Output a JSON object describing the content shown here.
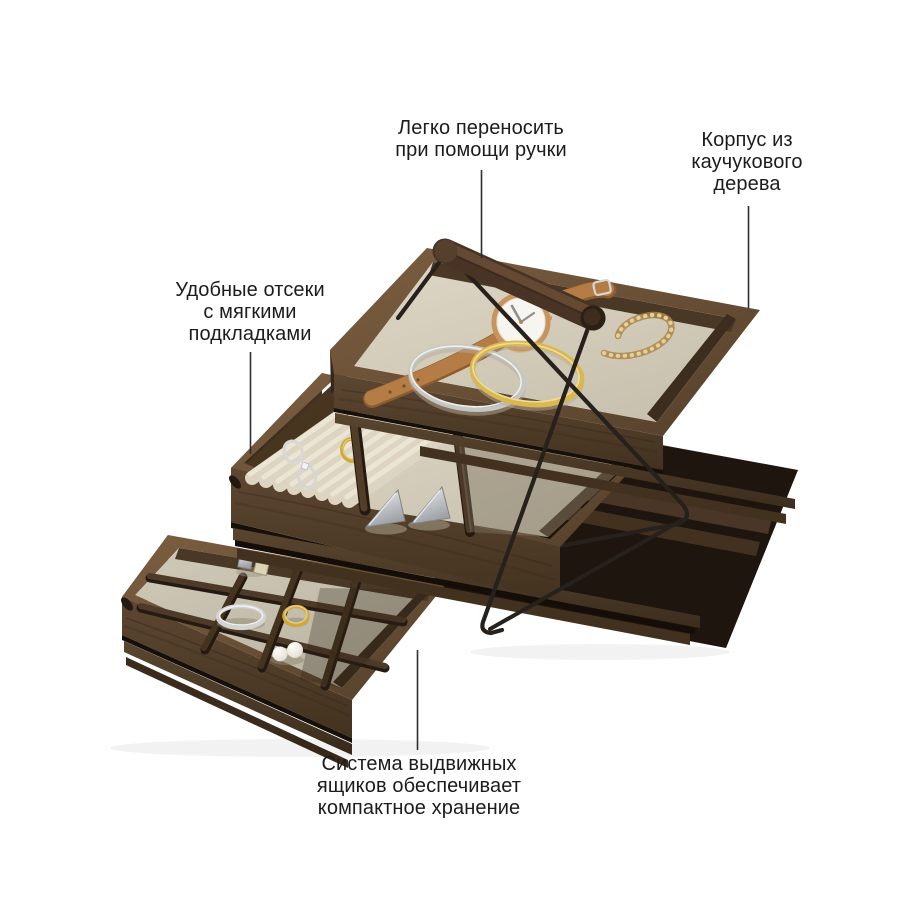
{
  "background": "#ffffff",
  "callouts": {
    "carry": {
      "lines": [
        "Легко переносить",
        "при помощи ручки"
      ]
    },
    "body": {
      "lines": [
        "Корпус из",
        "каучукового",
        "дерева"
      ]
    },
    "compartments": {
      "lines": [
        "Удобные отсеки",
        "с мягкими",
        "подкладками"
      ]
    },
    "drawers": {
      "lines": [
        "Система выдвижных",
        "ящиков обеспечивает",
        "компактное хранение"
      ]
    }
  },
  "palette": {
    "wood_dark": "#3a2b1e",
    "wood_mid": "#54402c",
    "wood_light": "#7a5c3e",
    "lining": "#d7d0bd",
    "metal_black": "#26211d",
    "gold": "#d2a93e",
    "silver": "#cdced0",
    "leather_tan": "#b57c46",
    "pearl": "#f3f1ec",
    "text": "#1c1c1c",
    "callout_line": "#2e2e2e"
  }
}
